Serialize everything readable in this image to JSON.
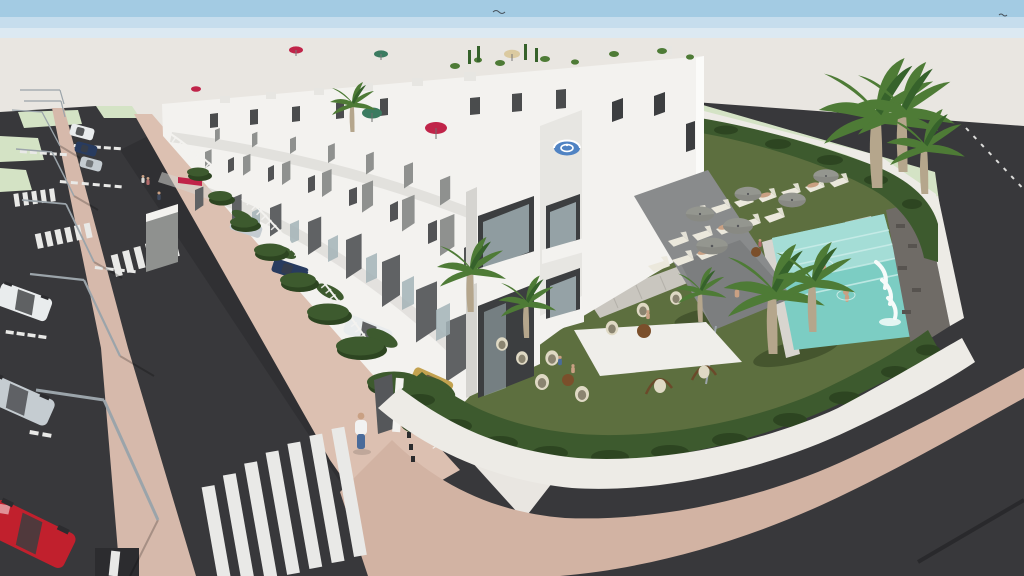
{
  "scene": {
    "title": "Aerial 3D architectural render of a white townhouse development with communal pool",
    "description": "Computer-generated aerial view of a modern residential complex: a long row of white two-storey townhouses with grey party walls, roof terraces with coloured parasols (red, teal, tan, blue-striped), hedge-lined front gardens with parked cars, a communal corner garden with lawn, grey parasols over white sun loungers, wicker egg chairs, tall palm trees and a turquoise pool with waterfall and two swimmers. Streets with pink paved median and sidewalks, streetlights, zebra crosswalks, parking bays and parked cars (white, dark blue, silver, red) surround the block under a pale blue sky.",
    "sky": {
      "condition": "clear, hazy horizon"
    },
    "buildings": {
      "style": "modern white townhouses",
      "storeys": 2,
      "units_visible": 12,
      "roof_features": [
        "plants",
        "parasols",
        "chimneys"
      ]
    },
    "amenities": {
      "pool": {
        "water_color_name": "turquoise",
        "swimmers": 2,
        "waterfall": true,
        "stone_feature_wall": true
      },
      "sun_loungers": 15,
      "grey_parasols": 6,
      "egg_chairs": 8,
      "hanging_chairs": 2,
      "round_tables": 3,
      "palm_trees": 10,
      "lawn": true,
      "perimeter_hedge": true,
      "curved_white_wall": true
    },
    "rooftop_parasols": [
      "red",
      "teal",
      "tan",
      "blue-white striped",
      "crimson"
    ],
    "streets": {
      "crosswalks": 4,
      "street_lamps": 7,
      "parking_bay_markings": 6,
      "parked_cars_street": [
        "white",
        "dark-blue",
        "silver",
        "white",
        "silver",
        "red"
      ],
      "driveway_cars": [
        "silver",
        "dark-blue",
        "white",
        "tan"
      ],
      "median": "pink paved strip with lamps",
      "sidewalk": "pink paving"
    },
    "people": {
      "pedestrians": 5,
      "garden_seating": 4,
      "on_loungers": 4,
      "in_pool": 2,
      "walking_on_lawn": 1
    }
  },
  "colors": {
    "sky_top": "#a3cbe3",
    "sky_mid": "#c6dded",
    "sky_low": "#dce9f2",
    "ground": "#e9e6e1",
    "road": "#38383b",
    "road_dark": "#2c2c2f",
    "stripe": "#e9e9e7",
    "median_pink": "#d6b9ab",
    "sidewalk_pink": "#dcc0b1",
    "paving_pink": "#d2b3a3",
    "wall_white": "#edebe6",
    "grass_pale": "#d4e3c5",
    "lawn": "#5d6f3f",
    "lawn_shadow": "#45552e",
    "hedge": "#3d5a2e",
    "hedge_dark": "#2d4521",
    "bldg_white": "#f3f2ef",
    "bldg_light": "#e7e6e2",
    "bldg_shade": "#d5d4d0",
    "panel_gray": "#8f918f",
    "panel_dark": "#606264",
    "win_dark": "#3c3e40",
    "glass": "#a4b4b8",
    "canopy": "#898b8c",
    "pool": "#7ccdc3",
    "pool_light": "#abdfd9",
    "stone": "#6f6b66",
    "umb_gray": "#94968f",
    "umb_gray_dark": "#7e807a",
    "umb_red": "#c02449",
    "umb_teal": "#3b7b60",
    "umb_tan": "#dbcaa0",
    "umb_blue": "#5083c3",
    "lounger": "#ebe8dc",
    "table_brown": "#7b4f2b",
    "wicker": "#dfd9c4",
    "wicker_dark": "#8a8470",
    "palm": "#4e7b36",
    "palm_dark": "#36622b",
    "trunk": "#b5a68c",
    "pole": "#9ba4aa",
    "skin": "#c9a083",
    "car_white": "#e9eced",
    "car_silver": "#c5ccd1",
    "car_blue": "#283b5f",
    "car_red": "#c1202d",
    "car_tan": "#c3a24f",
    "denim": "#4a6b9a",
    "shirt_white": "#f2f2f2"
  }
}
